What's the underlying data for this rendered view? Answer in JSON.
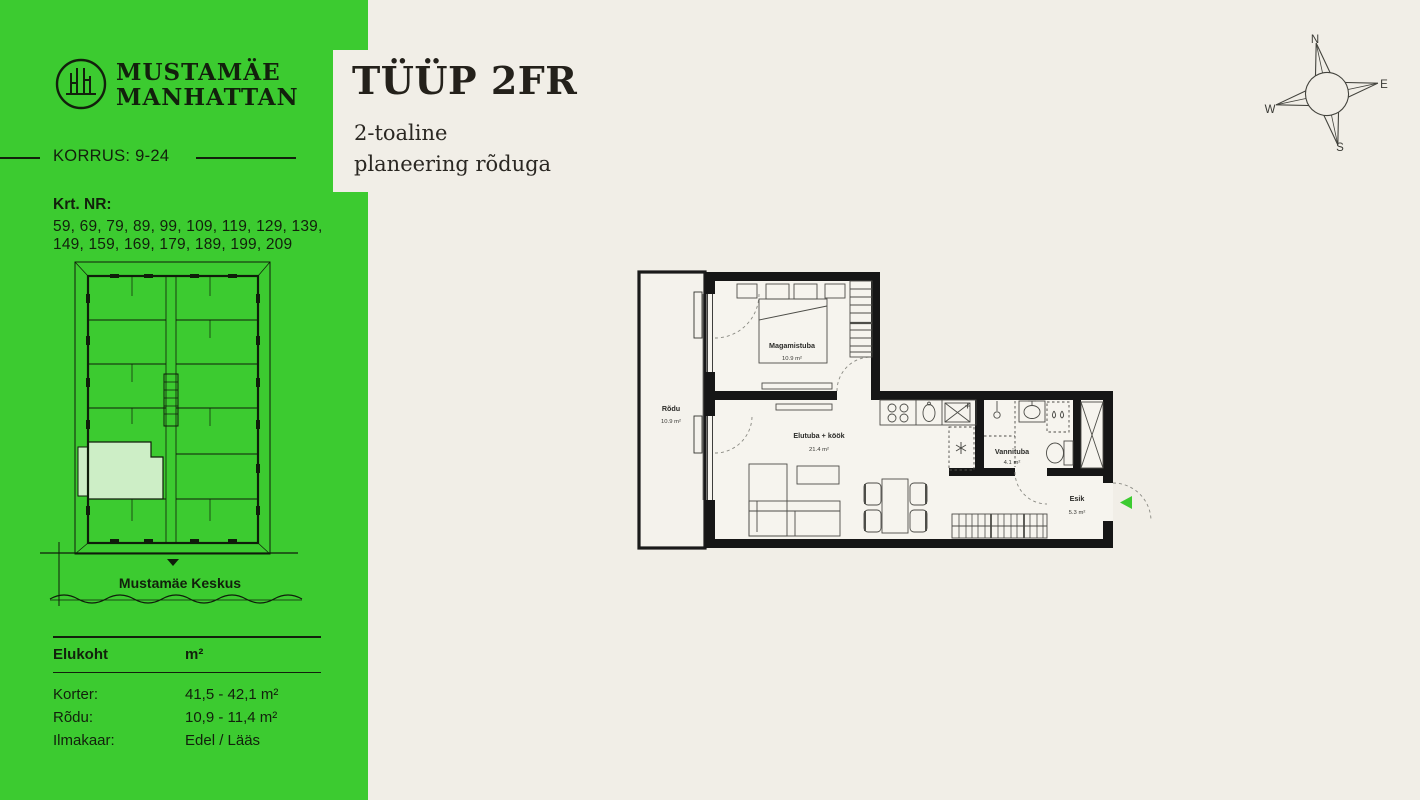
{
  "theme": {
    "brand_green": "#3ccb30",
    "highlight_unit_green": "#cdeec6",
    "background_beige": "#f1eee7",
    "ink_on_green": "#12200c",
    "plan_wall_black": "#161616"
  },
  "sidebar": {
    "brand": {
      "line1": "MUSTAMÄE",
      "line2": "MANHATTAN",
      "logo": "building-in-circle"
    },
    "korrus_label": "KORRUS: 9-24",
    "krt_label": "Krt. NR:",
    "krt_numbers_line1": "59, 69, 79, 89, 99, 109, 119, 129, 139,",
    "krt_numbers_line2": "149, 159, 169, 179, 189, 199, 209",
    "map_caption": "Mustamäe Keskus",
    "table": {
      "header": {
        "col1": "Elukoht",
        "col2": "m²"
      },
      "rows": [
        {
          "label": "Korter:",
          "value": "41,5 - 42,1 m²"
        },
        {
          "label": "Rõdu:",
          "value": "10,9 - 11,4 m²"
        },
        {
          "label": "Ilmakaar:",
          "value": "Edel / Lääs"
        }
      ]
    }
  },
  "main": {
    "title": "TÜÜP 2FR",
    "subtitle_line1": "2-toaline",
    "subtitle_line2": "planeering rõduga",
    "compass": {
      "n": "N",
      "e": "E",
      "s": "S",
      "w": "W"
    },
    "floorplan": {
      "rooms": [
        {
          "name": "Rõdu",
          "area": "10.9 m²"
        },
        {
          "name": "Magamistuba",
          "area": "10.9 m²"
        },
        {
          "name": "Elutuba + köök",
          "area": "21.4 m²"
        },
        {
          "name": "Vannituba",
          "area": "4.1 m²"
        },
        {
          "name": "Esik",
          "area": "5.3 m²"
        }
      ]
    }
  }
}
